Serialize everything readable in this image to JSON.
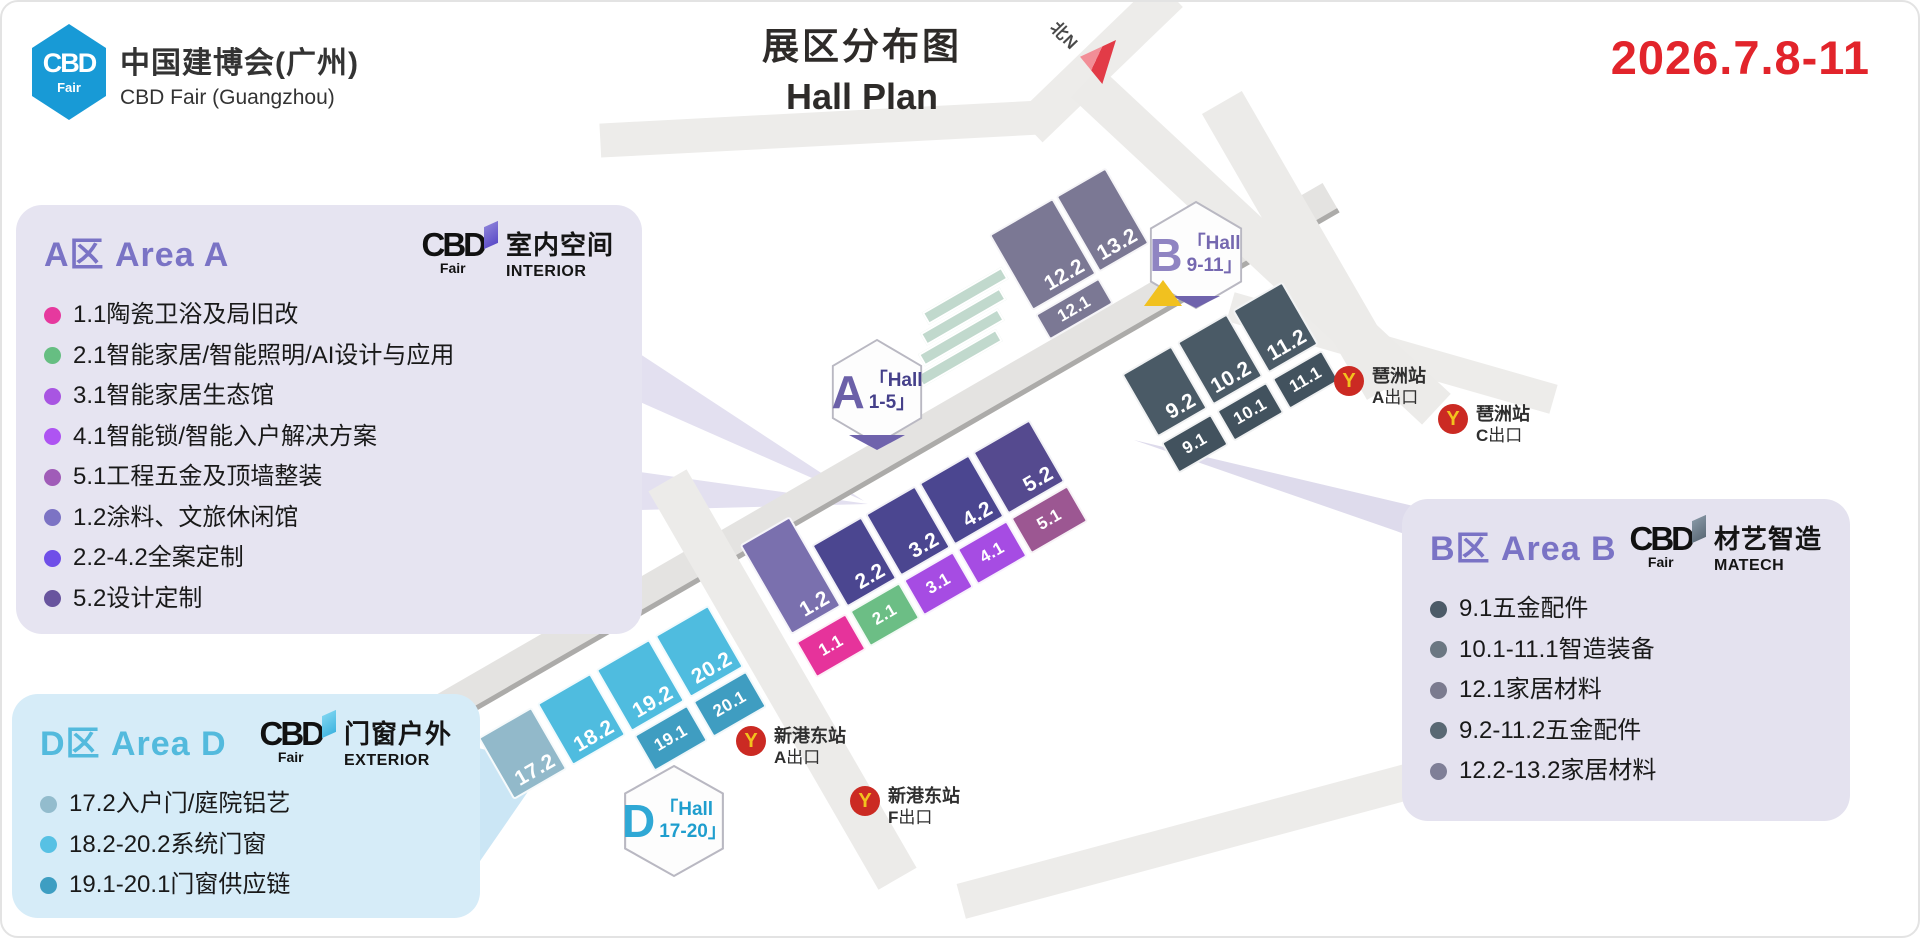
{
  "header": {
    "logo": {
      "abbr": "CBD",
      "sub": "Fair"
    },
    "brand_cn": "中国建博会(广州)",
    "brand_en": "CBD Fair (Guangzhou)",
    "title_cn": "展区分布图",
    "title_en": "Hall Plan",
    "date": "2026.7.8-11",
    "date_color": "#E2242B",
    "north_label": "北N"
  },
  "panels": {
    "a": {
      "title": "A区 Area A",
      "accent": "#7A73C5",
      "bg": "#E6E4F1",
      "logo_abbr": "CBD",
      "logo_sub": "Fair",
      "flag_color": "#6C5BD0",
      "tag_cn": "室内空间",
      "tag_en": "INTERIOR",
      "items": [
        {
          "c": "#E6399E",
          "t": "1.1陶瓷卫浴及局旧改"
        },
        {
          "c": "#66BE82",
          "t": "2.1智能家居/智能照明/AI设计与应用"
        },
        {
          "c": "#A855E2",
          "t": "3.1智能家居生态馆"
        },
        {
          "c": "#AE54F2",
          "t": "4.1智能锁/智能入户解决方案"
        },
        {
          "c": "#A05CB8",
          "t": "5.1工程五金及顶墙整装"
        },
        {
          "c": "#7C73C4",
          "t": "1.2涂料、文旅休闲馆"
        },
        {
          "c": "#6F4FE8",
          "t": "2.2-4.2全案定制"
        },
        {
          "c": "#68549E",
          "t": "5.2设计定制"
        }
      ]
    },
    "b": {
      "title": "B区 Area B",
      "accent": "#7A73C5",
      "bg": "#E4E2EF",
      "logo_abbr": "CBD",
      "logo_sub": "Fair",
      "flag_color": "#5C6B78",
      "tag_cn": "材艺智造",
      "tag_en": "MATECH",
      "items": [
        {
          "c": "#4C5B68",
          "t": "9.1五金配件"
        },
        {
          "c": "#6B7782",
          "t": "10.1-11.1智造装备"
        },
        {
          "c": "#7B7B8F",
          "t": "12.1家居材料"
        },
        {
          "c": "#596873",
          "t": "9.2-11.2五金配件"
        },
        {
          "c": "#7F7F97",
          "t": "12.2-13.2家居材料"
        }
      ]
    },
    "d": {
      "title": "D区 Area D",
      "accent": "#53BADD",
      "bg": "#D6ECF8",
      "logo_abbr": "CBD",
      "logo_sub": "Fair",
      "flag_color": "#3FB4E0",
      "tag_cn": "门窗户外",
      "tag_en": "EXTERIOR",
      "items": [
        {
          "c": "#93BCCD",
          "t": "17.2入户门/庭院铝艺"
        },
        {
          "c": "#57C1E4",
          "t": "18.2-20.2系统门窗"
        },
        {
          "c": "#3E9EC2",
          "t": "19.1-20.1门窗供应链"
        }
      ]
    }
  },
  "badges": {
    "a": {
      "letter": "A",
      "l1": "「Hall",
      "l2": "1-5」"
    },
    "b": {
      "letter": "B",
      "l1": "「Hall",
      "l2": "9-11」"
    },
    "d": {
      "letter": "D",
      "l1": "「Hall",
      "l2": "17-20」"
    }
  },
  "map": {
    "halls": [
      {
        "label": "1.2",
        "c": "#7A70AE",
        "cls": "h12"
      },
      {
        "label": "1.1",
        "c": "#E6339B",
        "cls": "h11",
        "small": true
      },
      {
        "label": "2.2",
        "c": "#4B4690",
        "cls": "h22"
      },
      {
        "label": "2.1",
        "c": "#6CBE85",
        "cls": "h21",
        "small": true
      },
      {
        "label": "3.2",
        "c": "#4B4690",
        "cls": "h32"
      },
      {
        "label": "3.1",
        "c": "#A64CE3",
        "cls": "h31",
        "small": true
      },
      {
        "label": "4.2",
        "c": "#4B4690",
        "cls": "h42"
      },
      {
        "label": "4.1",
        "c": "#A64CE3",
        "cls": "h41",
        "small": true
      },
      {
        "label": "5.2",
        "c": "#554A8F",
        "cls": "h52"
      },
      {
        "label": "5.1",
        "c": "#9C5792",
        "cls": "h51",
        "small": true
      },
      {
        "label": "9.2",
        "c": "#4A5A66",
        "cls": "h92"
      },
      {
        "label": "9.1",
        "c": "#42525E",
        "cls": "h91",
        "small": true
      },
      {
        "label": "10.2",
        "c": "#4A5A66",
        "cls": "h102"
      },
      {
        "label": "10.1",
        "c": "#42525E",
        "cls": "h101",
        "small": true
      },
      {
        "label": "11.2",
        "c": "#4A5A66",
        "cls": "h112"
      },
      {
        "label": "11.1",
        "c": "#42525E",
        "cls": "h111",
        "small": true
      },
      {
        "label": "12.2",
        "c": "#7B7894",
        "cls": "h122"
      },
      {
        "label": "12.1",
        "c": "#7B7894",
        "cls": "h121",
        "small": true
      },
      {
        "label": "13.2",
        "c": "#7B7894",
        "cls": "h132"
      },
      {
        "label": "17.2",
        "c": "#92B9CA",
        "cls": "h172"
      },
      {
        "label": "18.2",
        "c": "#4FBCDF",
        "cls": "h182"
      },
      {
        "label": "19.2",
        "c": "#4FBCDF",
        "cls": "h192"
      },
      {
        "label": "19.1",
        "c": "#3F9DC1",
        "cls": "h191",
        "small": true
      },
      {
        "label": "20.2",
        "c": "#4FBCDF",
        "cls": "h202"
      },
      {
        "label": "20.1",
        "c": "#3F9DC1",
        "cls": "h201",
        "small": true
      }
    ],
    "metro": [
      {
        "cls": "m-pza",
        "station": "琶洲站",
        "exit_letter": "A",
        "exit_word": "出口"
      },
      {
        "cls": "m-pzc",
        "station": "琶洲站",
        "exit_letter": "C",
        "exit_word": "出口"
      },
      {
        "cls": "m-xga",
        "station": "新港东站",
        "exit_letter": "A",
        "exit_word": "出口"
      },
      {
        "cls": "m-xgf",
        "station": "新港东站",
        "exit_letter": "F",
        "exit_word": "出口"
      }
    ],
    "metro_icon": "Y"
  }
}
